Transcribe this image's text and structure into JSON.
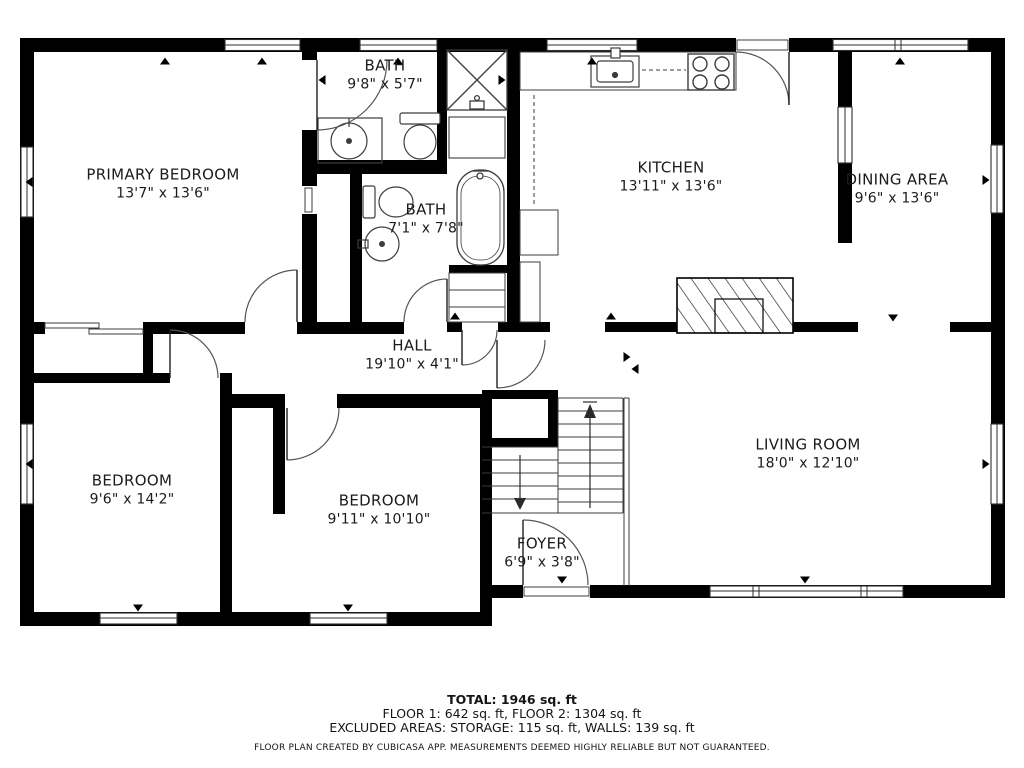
{
  "title": "Floor plan",
  "rooms": [
    {
      "name": "PRIMARY BEDROOM",
      "dims": "13'7\" x 13'6\"",
      "x": 163,
      "y": 184
    },
    {
      "name": "BATH",
      "dims": "9'8\" x 5'7\"",
      "x": 385,
      "y": 75
    },
    {
      "name": "KITCHEN",
      "dims": "13'11\" x 13'6\"",
      "x": 671,
      "y": 177
    },
    {
      "name": "DINING AREA",
      "dims": "9'6\" x 13'6\"",
      "x": 897,
      "y": 189
    },
    {
      "name": "BATH",
      "dims": "7'1\" x 7'8\"",
      "x": 426,
      "y": 219
    },
    {
      "name": "HALL",
      "dims": "19'10\" x 4'1\"",
      "x": 412,
      "y": 355
    },
    {
      "name": "BEDROOM",
      "dims": "9'6\" x 14'2\"",
      "x": 132,
      "y": 490
    },
    {
      "name": "BEDROOM",
      "dims": "9'11\" x 10'10\"",
      "x": 379,
      "y": 510
    },
    {
      "name": "LIVING ROOM",
      "dims": "18'0\" x 12'10\"",
      "x": 808,
      "y": 454
    },
    {
      "name": "FOYER",
      "dims": "6'9\" x 3'8\"",
      "x": 542,
      "y": 553
    }
  ],
  "footer": {
    "total": "TOTAL: 1946 sq. ft",
    "floors": "FLOOR 1: 642 sq. ft, FLOOR 2: 1304 sq. ft",
    "excluded": "EXCLUDED AREAS: STORAGE: 115 sq. ft, WALLS: 139 sq. ft",
    "disclaimer": "FLOOR PLAN CREATED BY CUBICASA APP. MEASUREMENTS DEEMED HIGHLY RELIABLE BUT NOT GUARANTEED."
  },
  "colors": {
    "wall": "#000000",
    "fixture_line": "#3c3c3c",
    "background": "#ffffff",
    "text": "#1b1b1b"
  }
}
